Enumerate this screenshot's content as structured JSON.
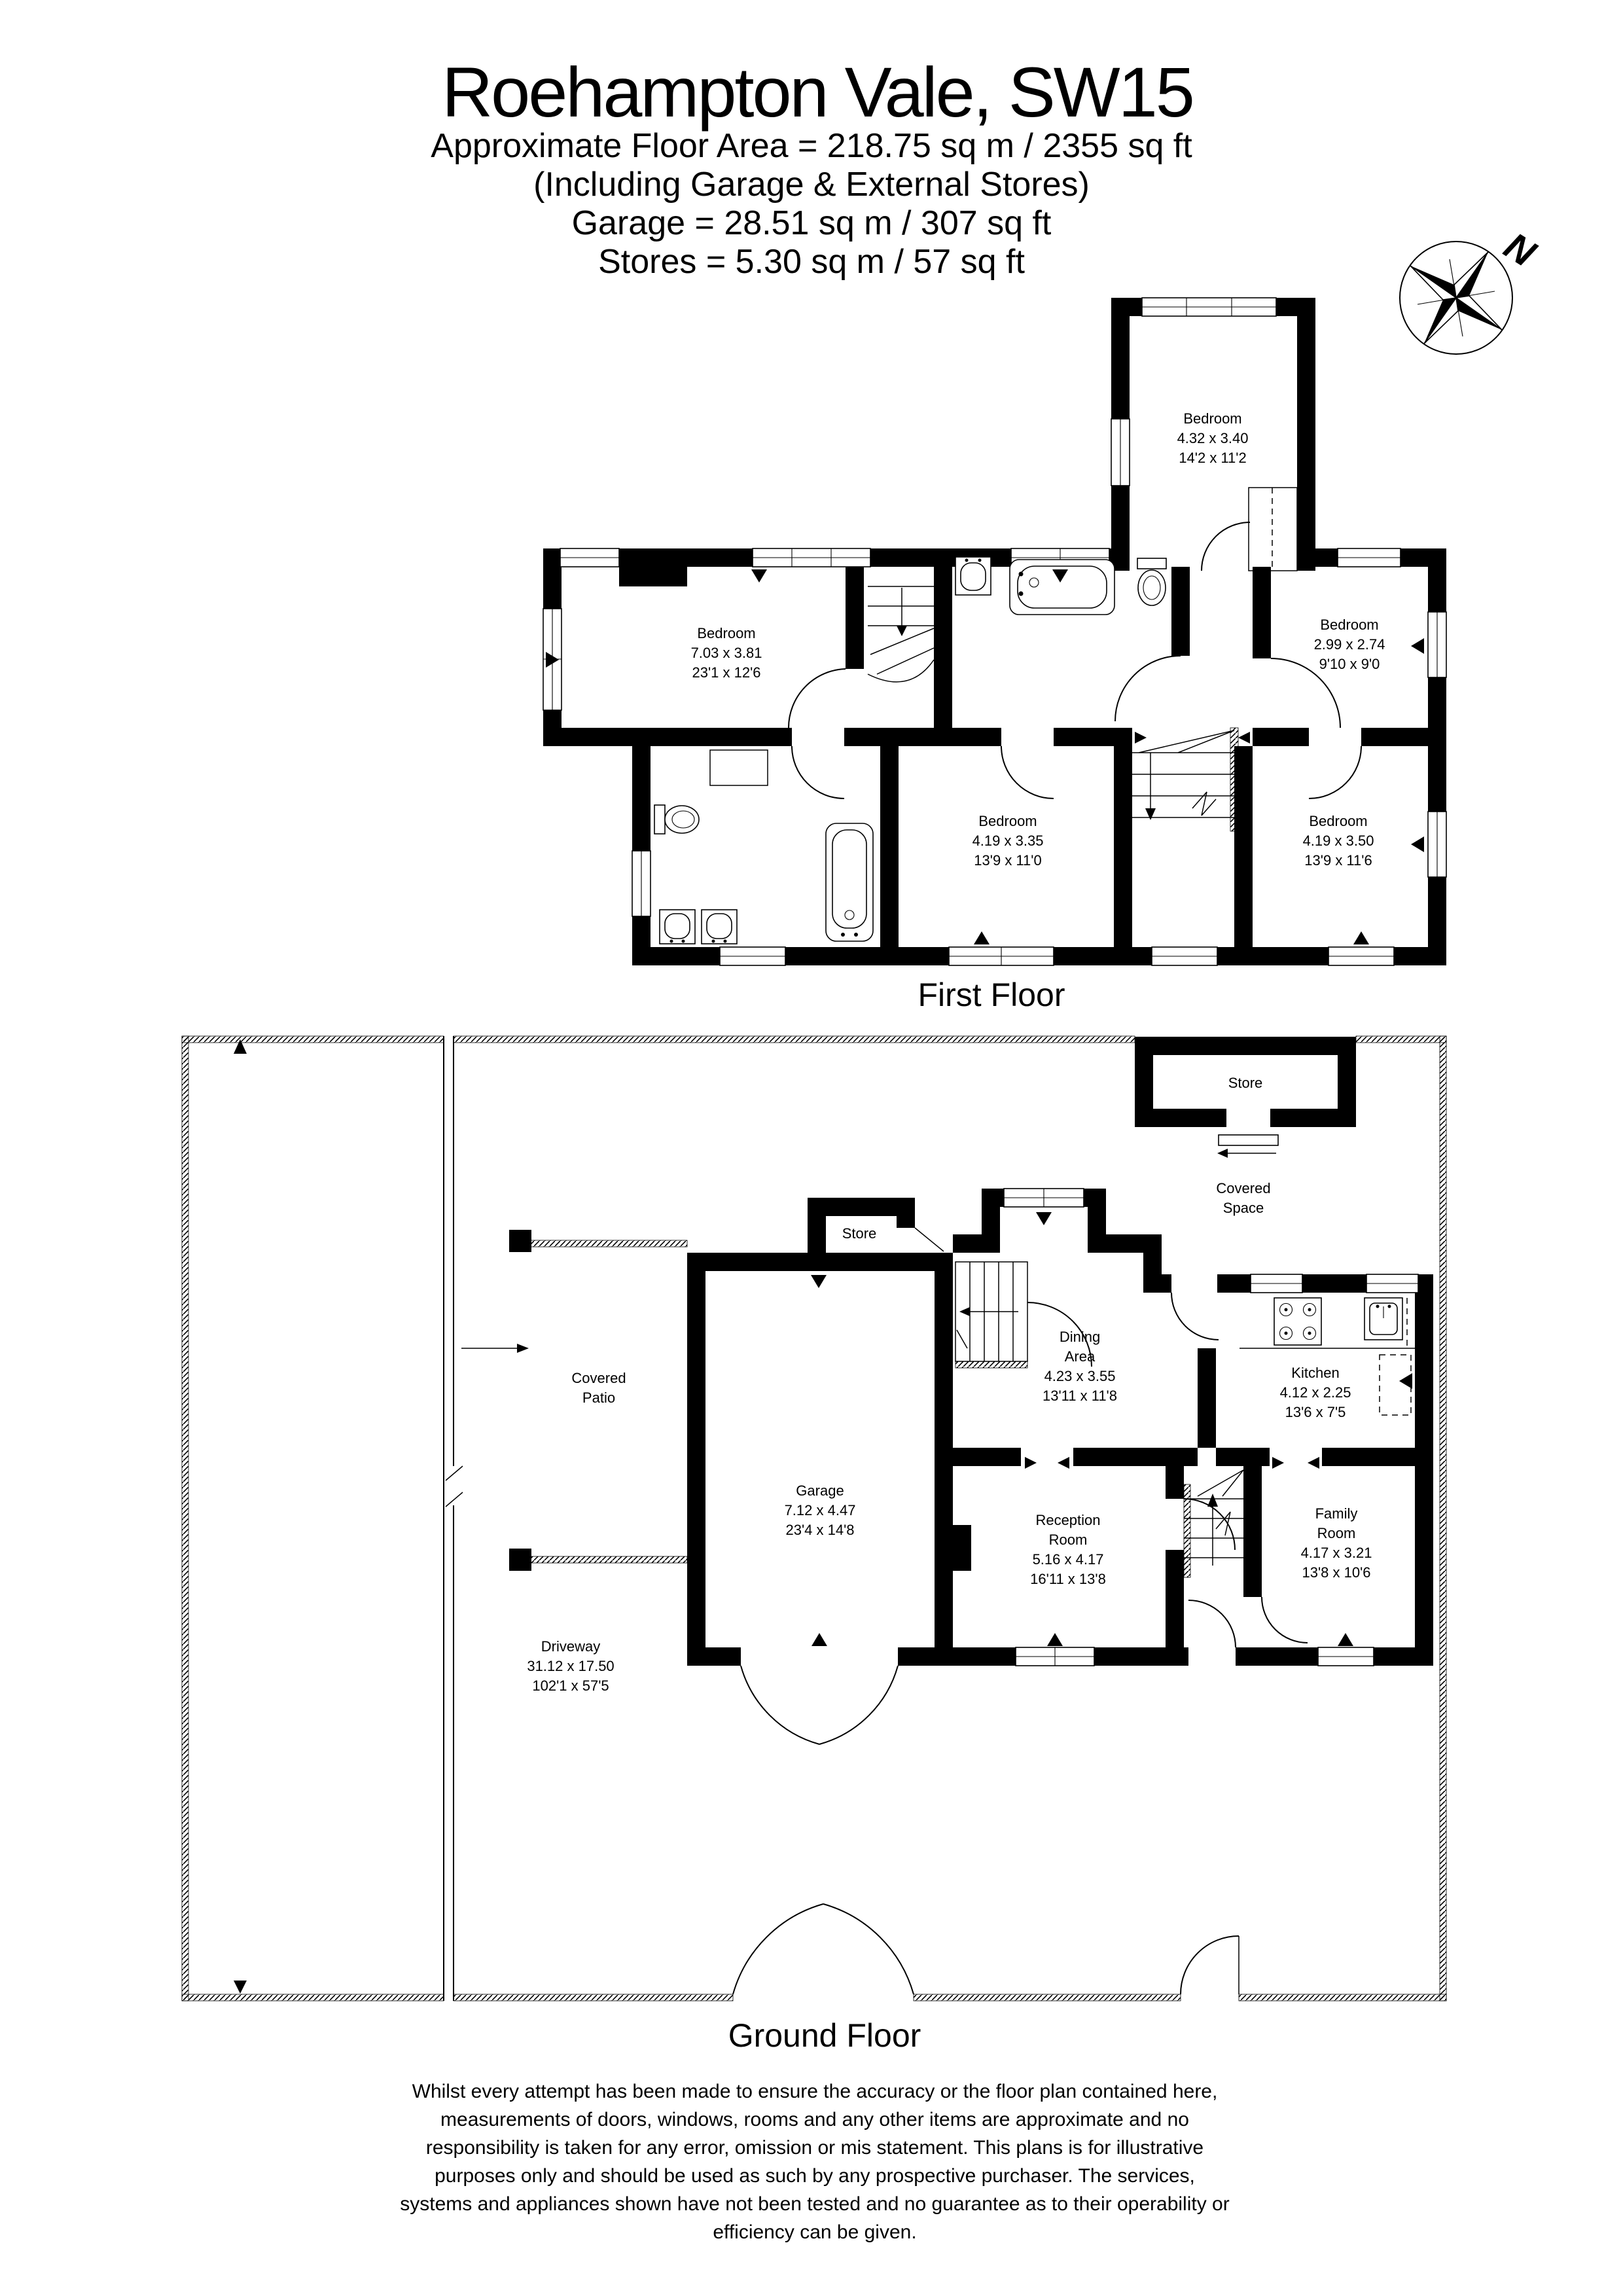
{
  "title_block": {
    "title": "Roehampton Vale, SW15",
    "area_line": "Approximate Floor Area = 218.75 sq m / 2355 sq ft",
    "including_line": "(Including Garage & External Stores)",
    "garage_line": "Garage = 28.51 sq m / 307 sq ft",
    "stores_line": "Stores = 5.30 sq m / 57 sq ft"
  },
  "compass": {
    "north_label": "N"
  },
  "first_floor": {
    "caption": "First Floor",
    "rooms": {
      "rear_bedroom": {
        "name": "Bedroom",
        "dim_m": "4.32 x 3.40",
        "dim_ft": "14'2 x 11'2"
      },
      "main_bedroom": {
        "name": "Bedroom",
        "dim_m": "7.03 x 3.81",
        "dim_ft": "23'1 x 12'6"
      },
      "small_bedroom": {
        "name": "Bedroom",
        "dim_m": "2.99 x 2.74",
        "dim_ft": "9'10 x 9'0"
      },
      "middle_bedroom": {
        "name": "Bedroom",
        "dim_m": "4.19 x 3.35",
        "dim_ft": "13'9 x 11'0"
      },
      "right_bedroom": {
        "name": "Bedroom",
        "dim_m": "4.19 x 3.50",
        "dim_ft": "13'9 x 11'6"
      }
    }
  },
  "ground_floor": {
    "caption": "Ground Floor",
    "rooms": {
      "external_store": {
        "name": "Store"
      },
      "covered_space": {
        "line1": "Covered",
        "line2": "Space"
      },
      "internal_store": {
        "name": "Store"
      },
      "dining_area": {
        "line1": "Dining",
        "line2": "Area",
        "dim_m": "4.23 x 3.55",
        "dim_ft": "13'11 x 11'8"
      },
      "kitchen": {
        "name": "Kitchen",
        "dim_m": "4.12 x 2.25",
        "dim_ft": "13'6 x 7'5"
      },
      "garage": {
        "name": "Garage",
        "dim_m": "7.12 x 4.47",
        "dim_ft": "23'4 x 14'8"
      },
      "reception_room": {
        "line1": "Reception",
        "line2": "Room",
        "dim_m": "5.16 x 4.17",
        "dim_ft": "16'11 x 13'8"
      },
      "family_room": {
        "line1": "Family",
        "line2": "Room",
        "dim_m": "4.17 x 3.21",
        "dim_ft": "13'8 x 10'6"
      },
      "covered_patio": {
        "line1": "Covered",
        "line2": "Patio"
      },
      "driveway": {
        "name": "Driveway",
        "dim_m": "31.12 x 17.50",
        "dim_ft": "102'1 x 57'5"
      }
    }
  },
  "disclaimer": {
    "line1": "Whilst every attempt has been made to ensure the accuracy or the floor plan contained here,",
    "line2": "measurements of doors, windows, rooms and any other items are approximate and no",
    "line3": "responsibility is taken for any error, omission or mis statement. This plans is for illustrative",
    "line4": "purposes only and should be used as such by any prospective purchaser. The services,",
    "line5": "systems and appliances shown have not been tested and no guarantee as to their operability or",
    "line6": "efficiency can be given."
  },
  "colors": {
    "ink": "#000000",
    "paper": "#ffffff"
  }
}
